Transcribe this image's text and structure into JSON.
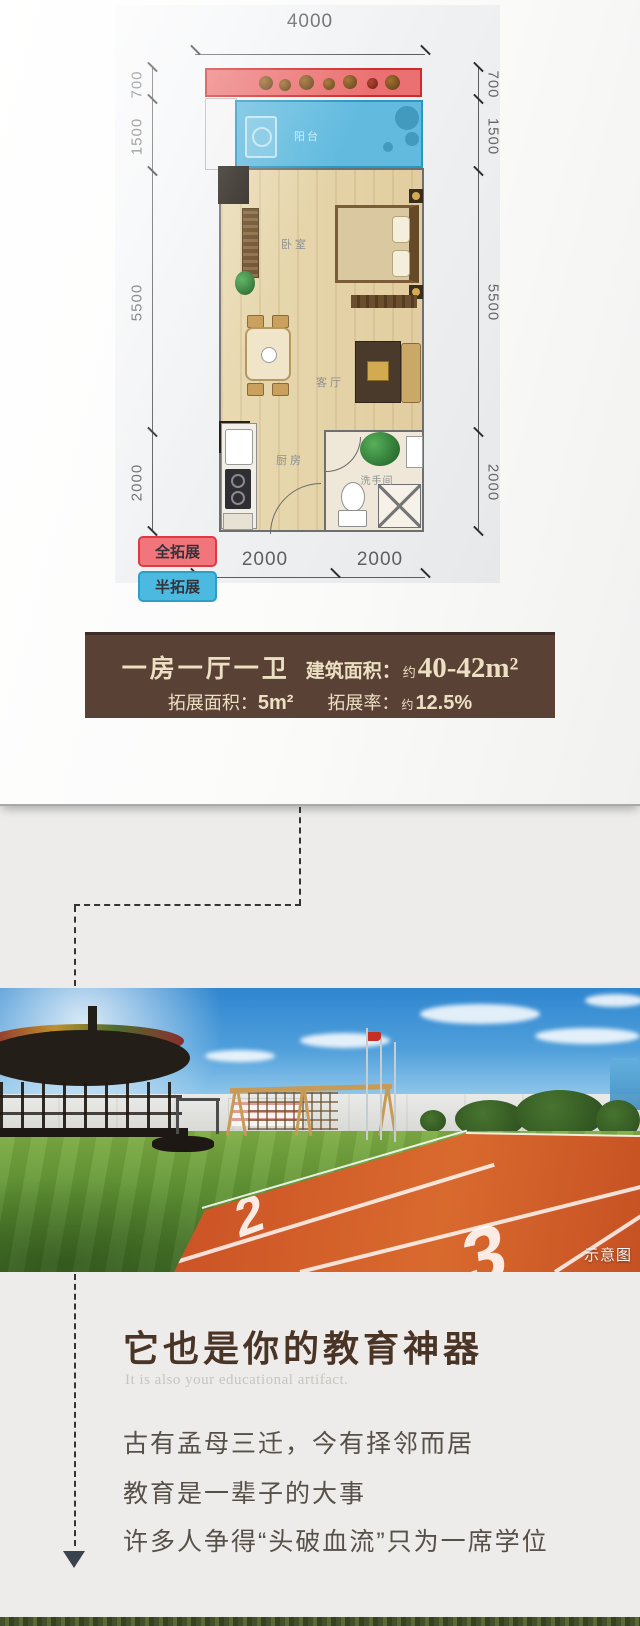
{
  "floorplan": {
    "dims": {
      "top": "4000",
      "left": [
        "700",
        "1500",
        "5500",
        "2000"
      ],
      "right": [
        "700",
        "1500",
        "5500",
        "2000"
      ],
      "bottom": [
        "2000",
        "2000"
      ]
    },
    "rooms": {
      "bedroom": "卧室",
      "living": "客厅",
      "kitchen": "厨房",
      "bathroom": "洗手间",
      "balcony": "阳台"
    },
    "legend": [
      {
        "label": "全拓展",
        "color": "#e8404a"
      },
      {
        "label": "半拓展",
        "color": "#45b5dd"
      }
    ]
  },
  "info_box": {
    "unit_type": "一房一厅一卫",
    "area_label": "建筑面积：",
    "area_approx": "约",
    "area_value": "40-42m²",
    "expand_area_label": "拓展面积：",
    "expand_area_value": "5m²",
    "expand_rate_label": "拓展率：",
    "expand_rate_approx": "约",
    "expand_rate_value": "12.5%"
  },
  "photo": {
    "watermark": "示意图",
    "lane_numbers": [
      "1",
      "2",
      "3"
    ]
  },
  "education": {
    "title": "它也是你的教育神器",
    "subtitle": "It is also your educational artifact.",
    "lines": [
      "古有孟母三迁，今有择邻而居",
      "教育是一辈子的大事",
      "许多人争得“头破血流”只为一席学位"
    ]
  }
}
